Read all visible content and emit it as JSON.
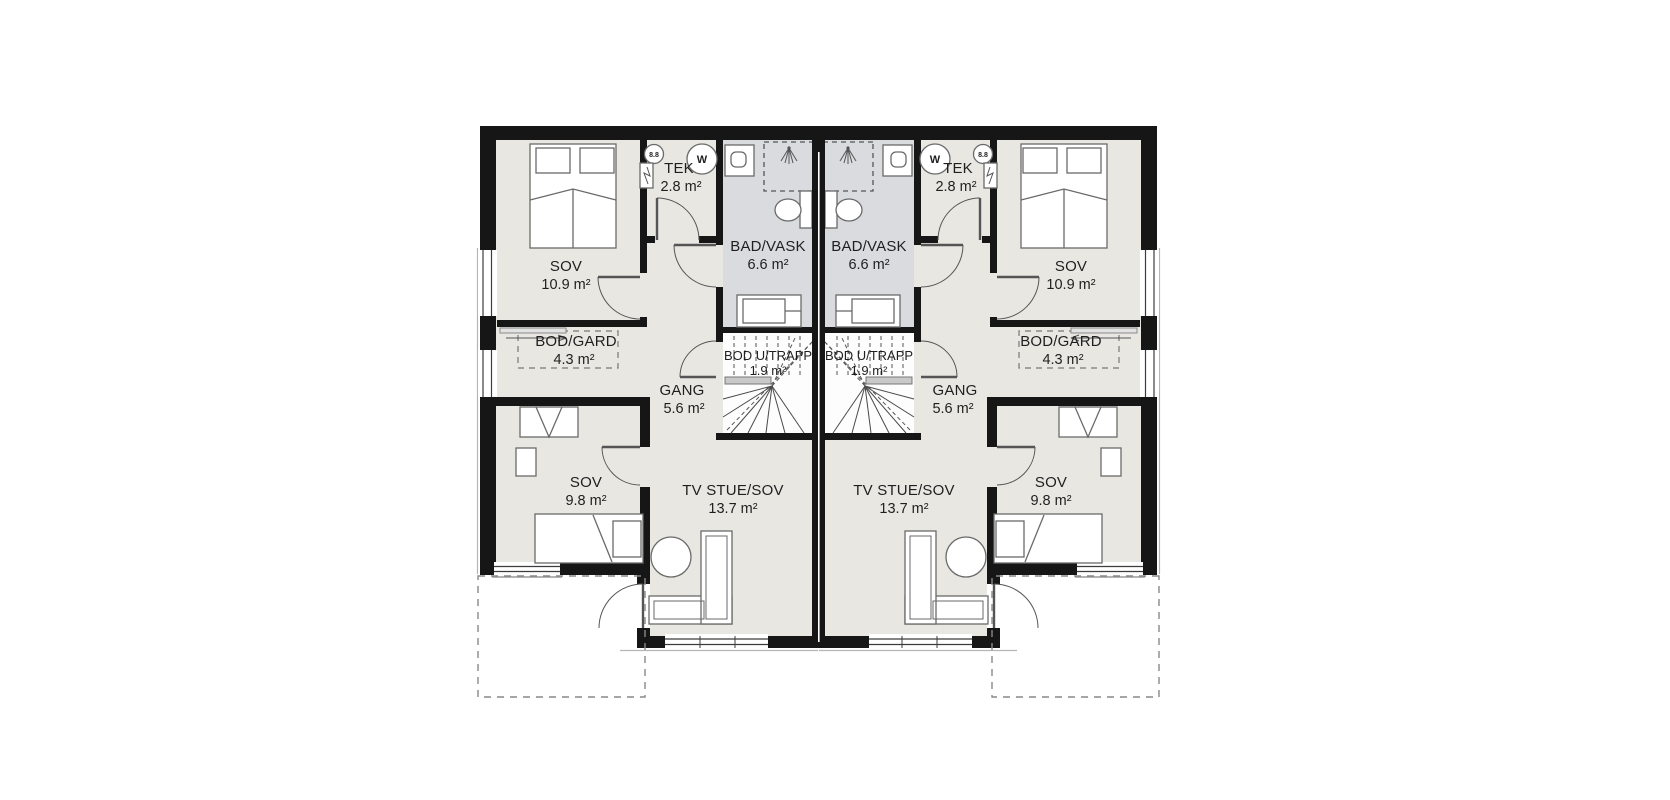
{
  "plan": {
    "type": "floor-plan",
    "rooms": {
      "sov_main": {
        "label": "SOV",
        "area": "10.9 m²"
      },
      "tek": {
        "label": "TEK",
        "area": "2.8 m²"
      },
      "bad": {
        "label": "BAD/VASK",
        "area": "6.6 m²"
      },
      "bod_gard": {
        "label": "BOD/GARD",
        "area": "4.3 m²"
      },
      "gang": {
        "label": "GANG",
        "area": "5.6 m²"
      },
      "bod_u_trapp": {
        "label": "BOD U/TRAPP",
        "area": "1.9 m²"
      },
      "sov_second": {
        "label": "SOV",
        "area": "9.8 m²"
      },
      "tv_stue": {
        "label": "TV STUE/SOV",
        "area": "13.7 m²"
      }
    },
    "markers": {
      "water_heater": "W",
      "detector": "8.8"
    },
    "colors": {
      "wall": "#161616",
      "room_fill": "#e8e7e2",
      "bath_fill": "#d9dbde",
      "dash": "#888888",
      "furniture_stroke": "#6a6a6a"
    }
  }
}
